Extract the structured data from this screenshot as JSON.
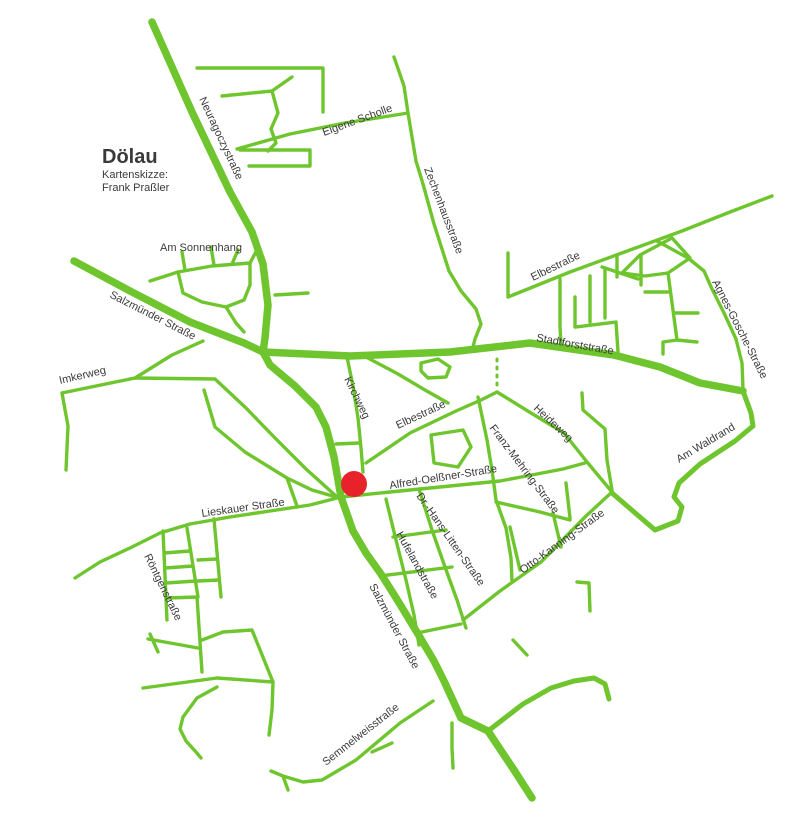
{
  "map": {
    "title": "Dölau",
    "subtitle_line1": "Kartenskizze:",
    "subtitle_line2": "Frank Praßler",
    "colors": {
      "road": "#6ec52e",
      "marker": "#e8222a",
      "text": "#3a3a3a",
      "background": "#ffffff"
    },
    "marker": {
      "label": "location-marker",
      "cx": 354,
      "cy": 484,
      "r": 13
    },
    "streets": {
      "neuragoczystrasse": "Neuragoczystraße",
      "eigene_scholle": "Eigene Scholle",
      "zechenhausstrasse": "Zechenhausstraße",
      "am_sonnenhang": "Am Sonnenhang",
      "salzmuender_strasse_nw": "Salzmünder Straße",
      "imkerweg": "Imkerweg",
      "elbestrasse_ne": "Elbestraße",
      "stadtforststrasse": "Stadtforststraße",
      "agnes_gosche_strasse": "Agnes-Gosche-Straße",
      "kirchweg": "Kirchweg",
      "elbestrasse_center": "Elbestraße",
      "heideweg": "Heideweg",
      "franz_mehring_strasse": "Franz-Mehring-Straße",
      "am_waldrand": "Am Waldrand",
      "alfred_oelssner_strasse": "Alfred-Oelßner-Straße",
      "lieskauer_strasse": "Lieskauer Straße",
      "dr_hans_litten_strasse": "Dr.-Hans-Litten-Straße",
      "otto_kanning_strasse": "Otto-Kanning-Straße",
      "hufelandstrasse": "Hufelandstraße",
      "roentgenstrasse": "Röntgenstraße",
      "salzmuender_strasse_s": "Salzmünder Straße",
      "semmelweisstrasse": "Semmelweisstraße"
    }
  }
}
